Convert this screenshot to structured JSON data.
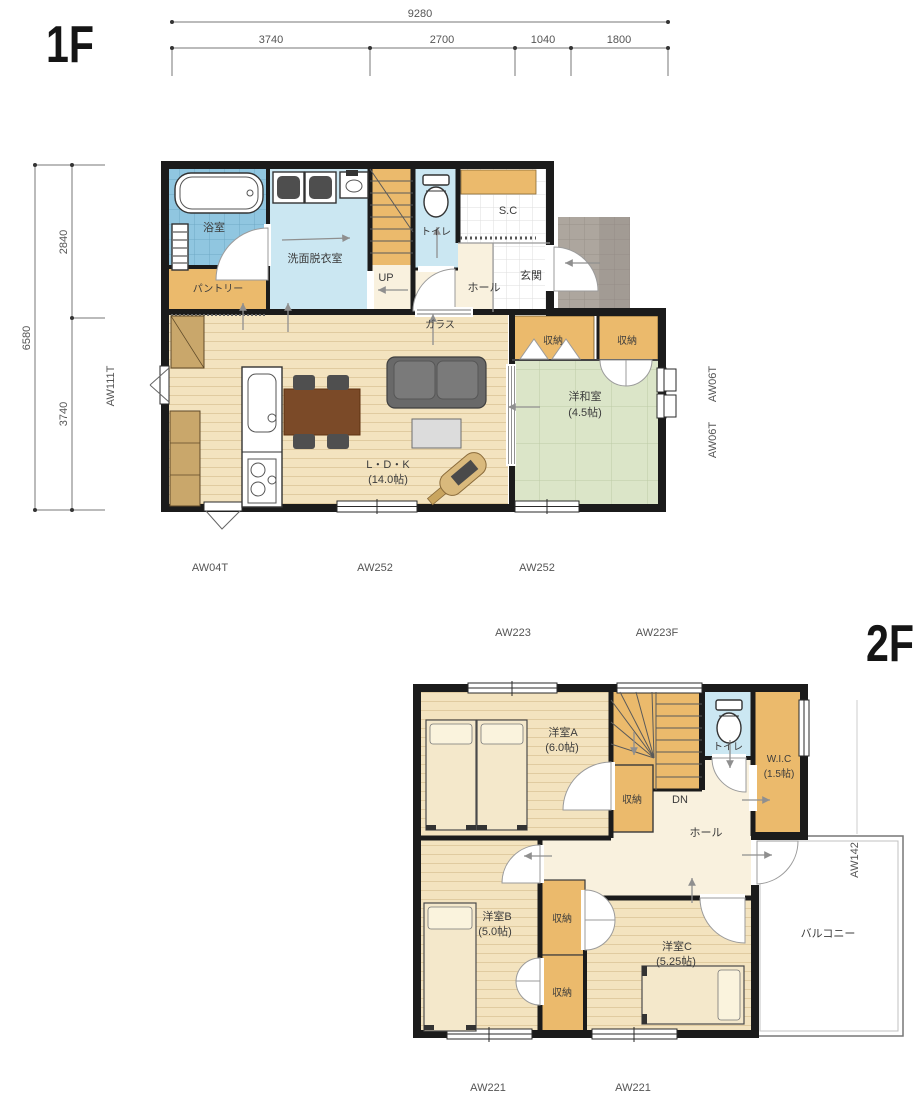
{
  "palette": {
    "wall": "#1b1b1b",
    "wood_floor": "#f3e3bf",
    "tatami_green": "#dbe5c8",
    "storage_orange": "#ebba6c",
    "hall_cream": "#f9f1de",
    "water_blue": "#cbe7f2",
    "bath_tile_blue": "#90c6e0",
    "porch_gray": "#ada69e",
    "table_brown": "#7b4a28",
    "sofa_gray": "#696969"
  },
  "floor1": {
    "label": "1F",
    "dimensions": {
      "total_width": "9280",
      "width_segments": [
        "3740",
        "2700",
        "1040",
        "1800"
      ],
      "total_height": "6580",
      "height_segments": [
        "2840",
        "3740"
      ]
    },
    "windows": {
      "left": "AW111T",
      "right_upper": "AW06T",
      "right_lower": "AW06T",
      "bottom_small": "AW04T",
      "bottom_ldk": "AW252",
      "bottom_washitsu": "AW252"
    },
    "rooms": {
      "bath": "浴室",
      "washroom": "洗面脱衣室",
      "pantry": "パントリー",
      "stairs_up": "UP",
      "toilet": "トイレ",
      "hall": "ホール",
      "shoe_closet": "S.C",
      "entrance": "玄関",
      "glass_note": "ガラス",
      "ldk": "L・D・K",
      "ldk_size": "(14.0帖)",
      "washitsu": "洋和室",
      "washitsu_size": "(4.5帖)",
      "storage_left": "収納",
      "storage_right": "収納"
    }
  },
  "floor2": {
    "label": "2F",
    "windows": {
      "top_left": "AW223",
      "top_right": "AW223F",
      "right": "AW142",
      "bottom_left": "AW221",
      "bottom_right": "AW221"
    },
    "rooms": {
      "room_a": "洋室A",
      "room_a_size": "(6.0帖)",
      "storage_stairs": "収納",
      "stairs_down": "DN",
      "toilet": "トイレ",
      "wic": "W.I.C",
      "wic_size": "(1.5帖)",
      "hall": "ホール",
      "room_b": "洋室B",
      "room_b_size": "(5.0帖)",
      "storage_b": "収納",
      "storage_b2": "収納",
      "room_c": "洋室C",
      "room_c_size": "(5.25帖)",
      "balcony": "バルコニー"
    }
  }
}
